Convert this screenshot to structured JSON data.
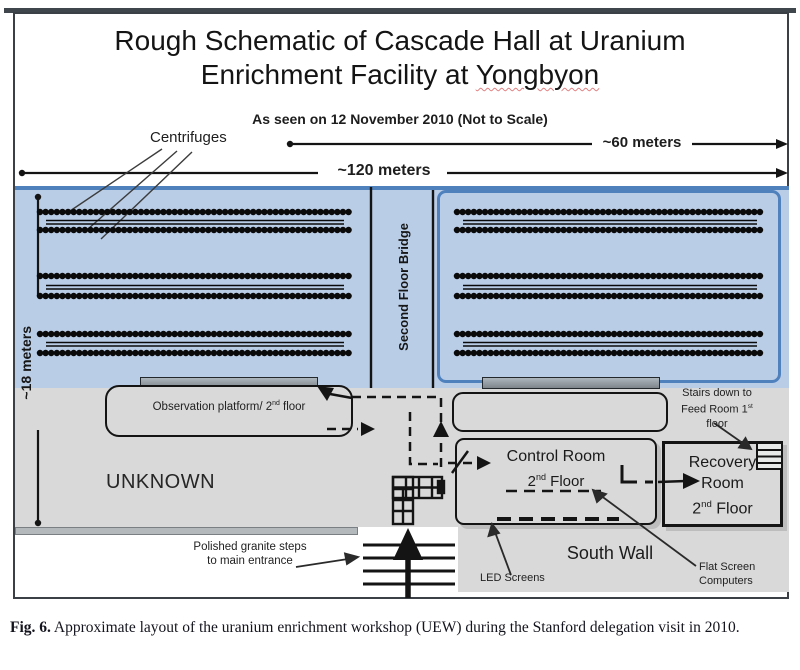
{
  "diagram": {
    "title_line1": "Rough Schematic of Cascade Hall at Uranium",
    "title_line2_prefix": "Enrichment Facility at ",
    "title_line2_underlined": "Yongbyon",
    "subtitle": "As seen on 12 November 2010 (Not to Scale)",
    "measurements": {
      "width_full": "~120 meters",
      "width_half": "~60 meters",
      "depth": "~18 meters"
    },
    "cascade": {
      "centrifuges_label": "Centrifuges",
      "bridge_label": "Second Floor Bridge",
      "centrifuge_row_groups": 3,
      "rows_per_group": 2,
      "sides": 2
    },
    "rooms": {
      "unknown": "UNKNOWN",
      "observation_prefix": "Observation platform/ 2",
      "observation_sup": "nd",
      "observation_suffix": " floor",
      "control_line1": "Control Room",
      "control_num": "2",
      "control_sup": "nd",
      "control_rest": " Floor",
      "recovery_line1": "Recovery",
      "recovery_line2": "Room",
      "recovery_num": "2",
      "recovery_sup": "nd",
      "recovery_rest": " Floor",
      "stairs_line1": "Stairs down to",
      "stairs_line2": "Feed Room 1",
      "stairs_sup": "st",
      "stairs_line3": "floor"
    },
    "annotations": {
      "south_wall": "South Wall",
      "led_screens": "LED Screens",
      "flat_screen_line1": "Flat Screen",
      "flat_screen_line2": "Computers",
      "granite_line1": "Polished granite steps",
      "granite_line2": "to main entrance"
    },
    "colors": {
      "cascade_fill": "#b9cde7",
      "cascade_border": "#4f81bd",
      "floor_gray": "#d9d9d9",
      "platform_bar_gray": "#8d959b",
      "wall_bar_gray": "#b4babc",
      "spellcheck_red": "#e08080",
      "ink": "#141414"
    }
  },
  "caption": {
    "fig_label": "Fig. 6.",
    "text": " Approximate layout of the uranium enrichment workshop (UEW) during the Stanford delegation visit in 2010."
  }
}
